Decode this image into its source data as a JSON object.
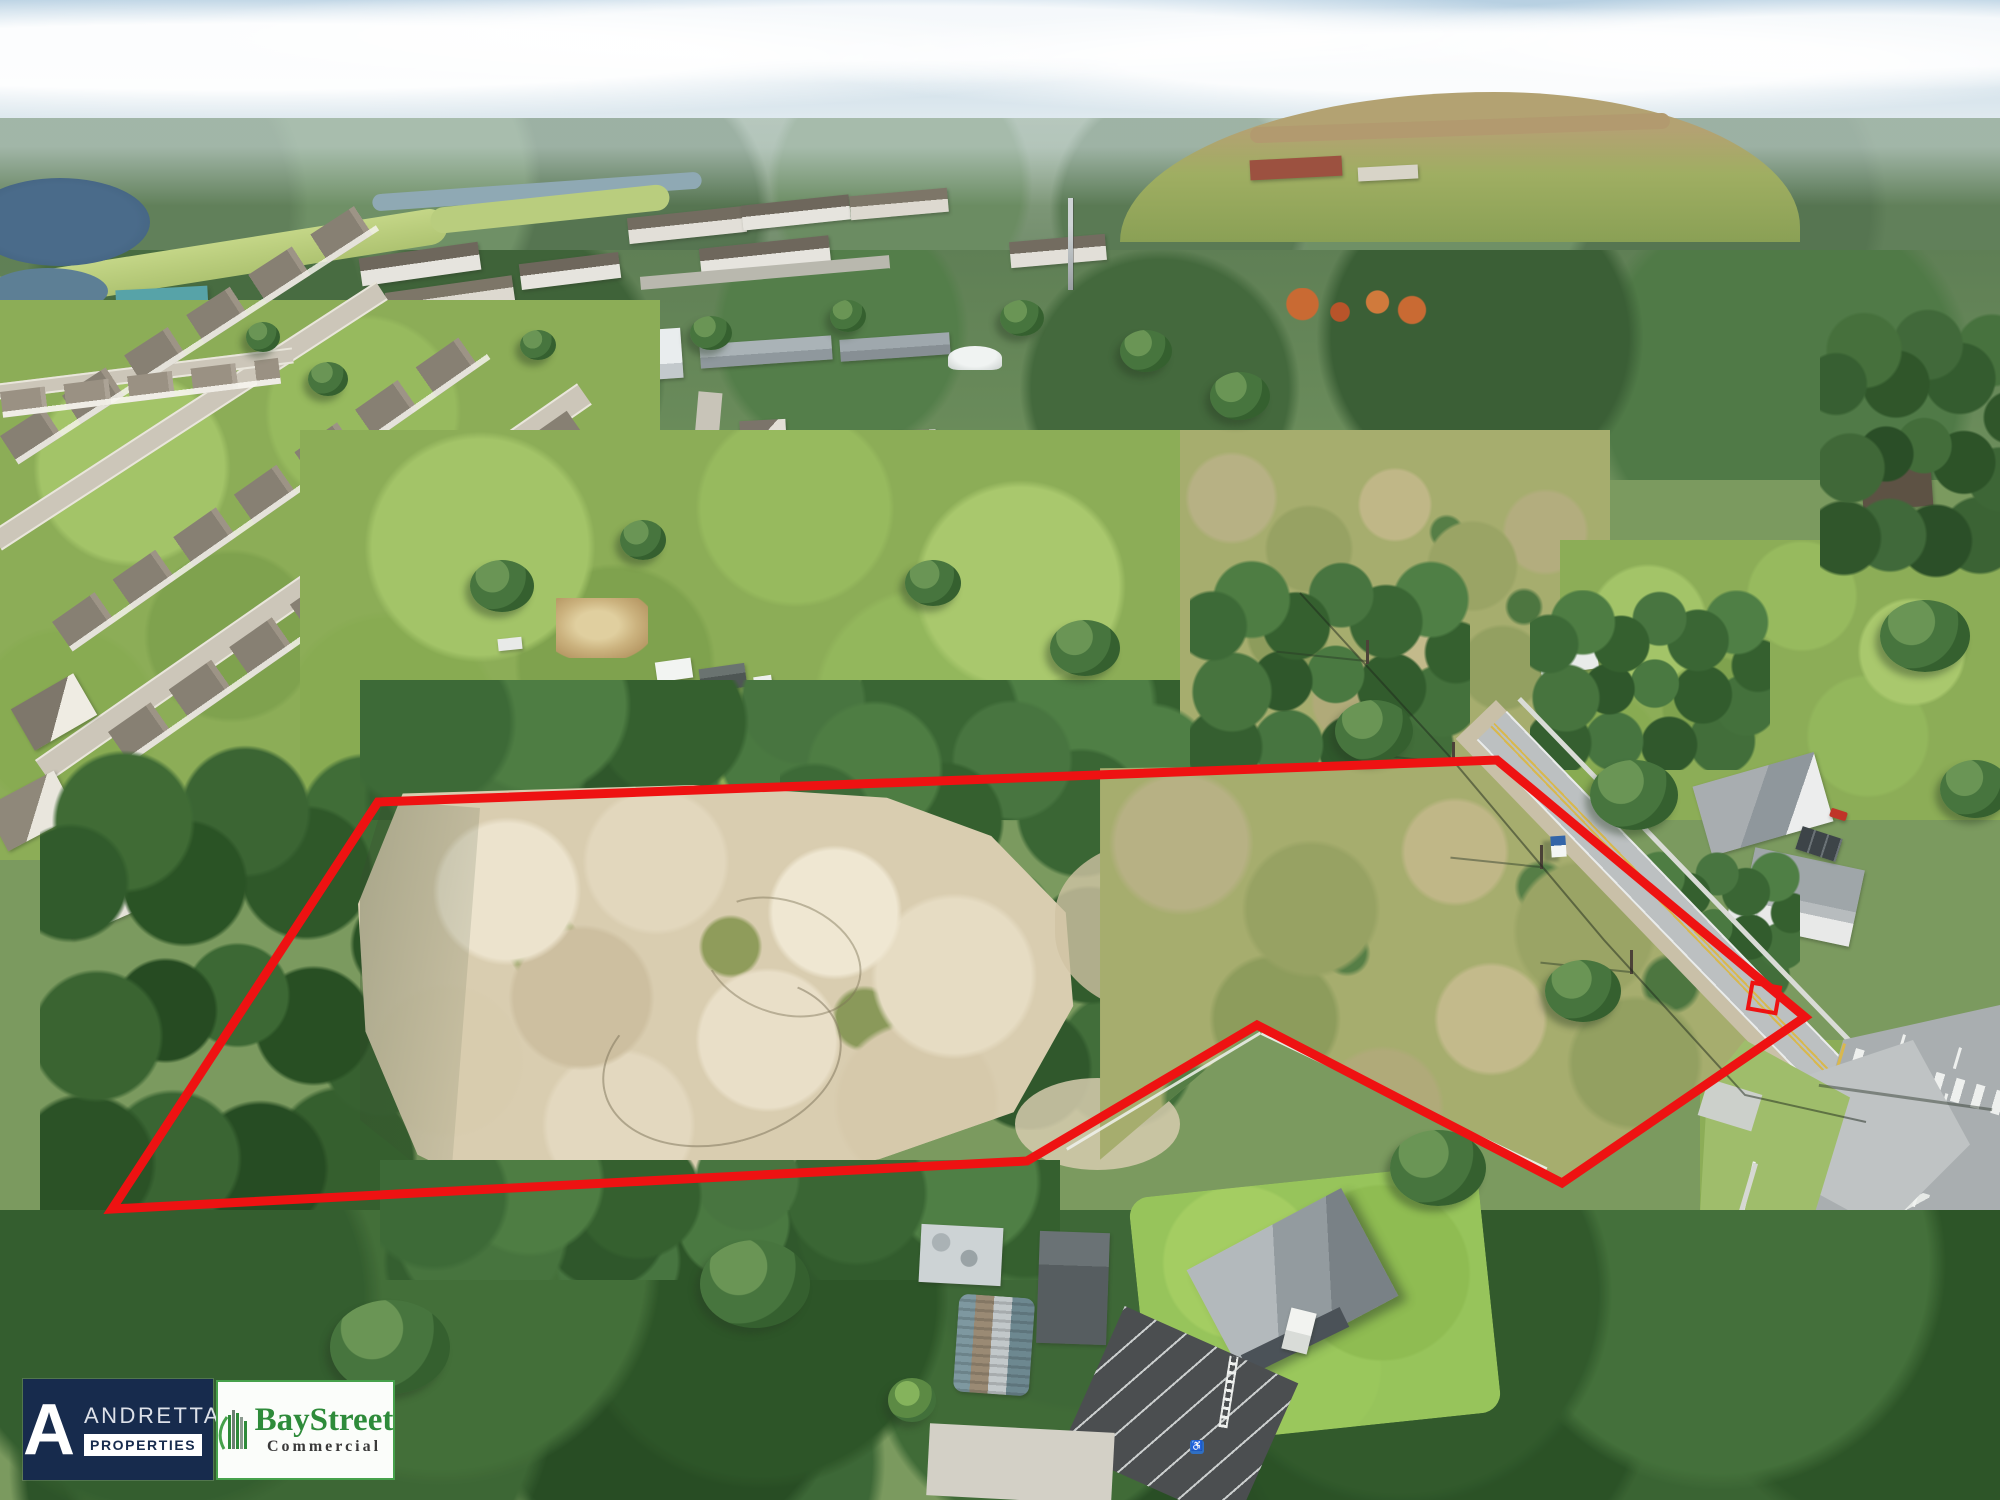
{
  "branding": {
    "andretta": {
      "monogram": "A",
      "name": "ANDRETTA",
      "suffix": "PROPERTIES",
      "bg_color": "#172b4d",
      "name_color": "#dde1e9",
      "suffix_color": "#172b4d",
      "suffix_bg": "#ffffff"
    },
    "baystreet": {
      "name": "BayStreet",
      "subtitle": "Commercial",
      "name_color": "#2e8b3a",
      "subtitle_color": "#3a3a3a",
      "border_color": "#46a14b",
      "bg_color": "#fbfdfa",
      "icon": "building-icon"
    }
  },
  "overlay": {
    "boundary_color": "#ee1212",
    "boundary_stroke_width": 9,
    "boundary_points": "378,802 1497,760 1805,1017 1562,1183 1257,1025 1027,1161 112,1209",
    "marker": {
      "x": 1750,
      "y": 985,
      "width": 28,
      "height": 26,
      "rotation": 10
    }
  },
  "markings": {
    "handicap_symbol": "♿"
  }
}
